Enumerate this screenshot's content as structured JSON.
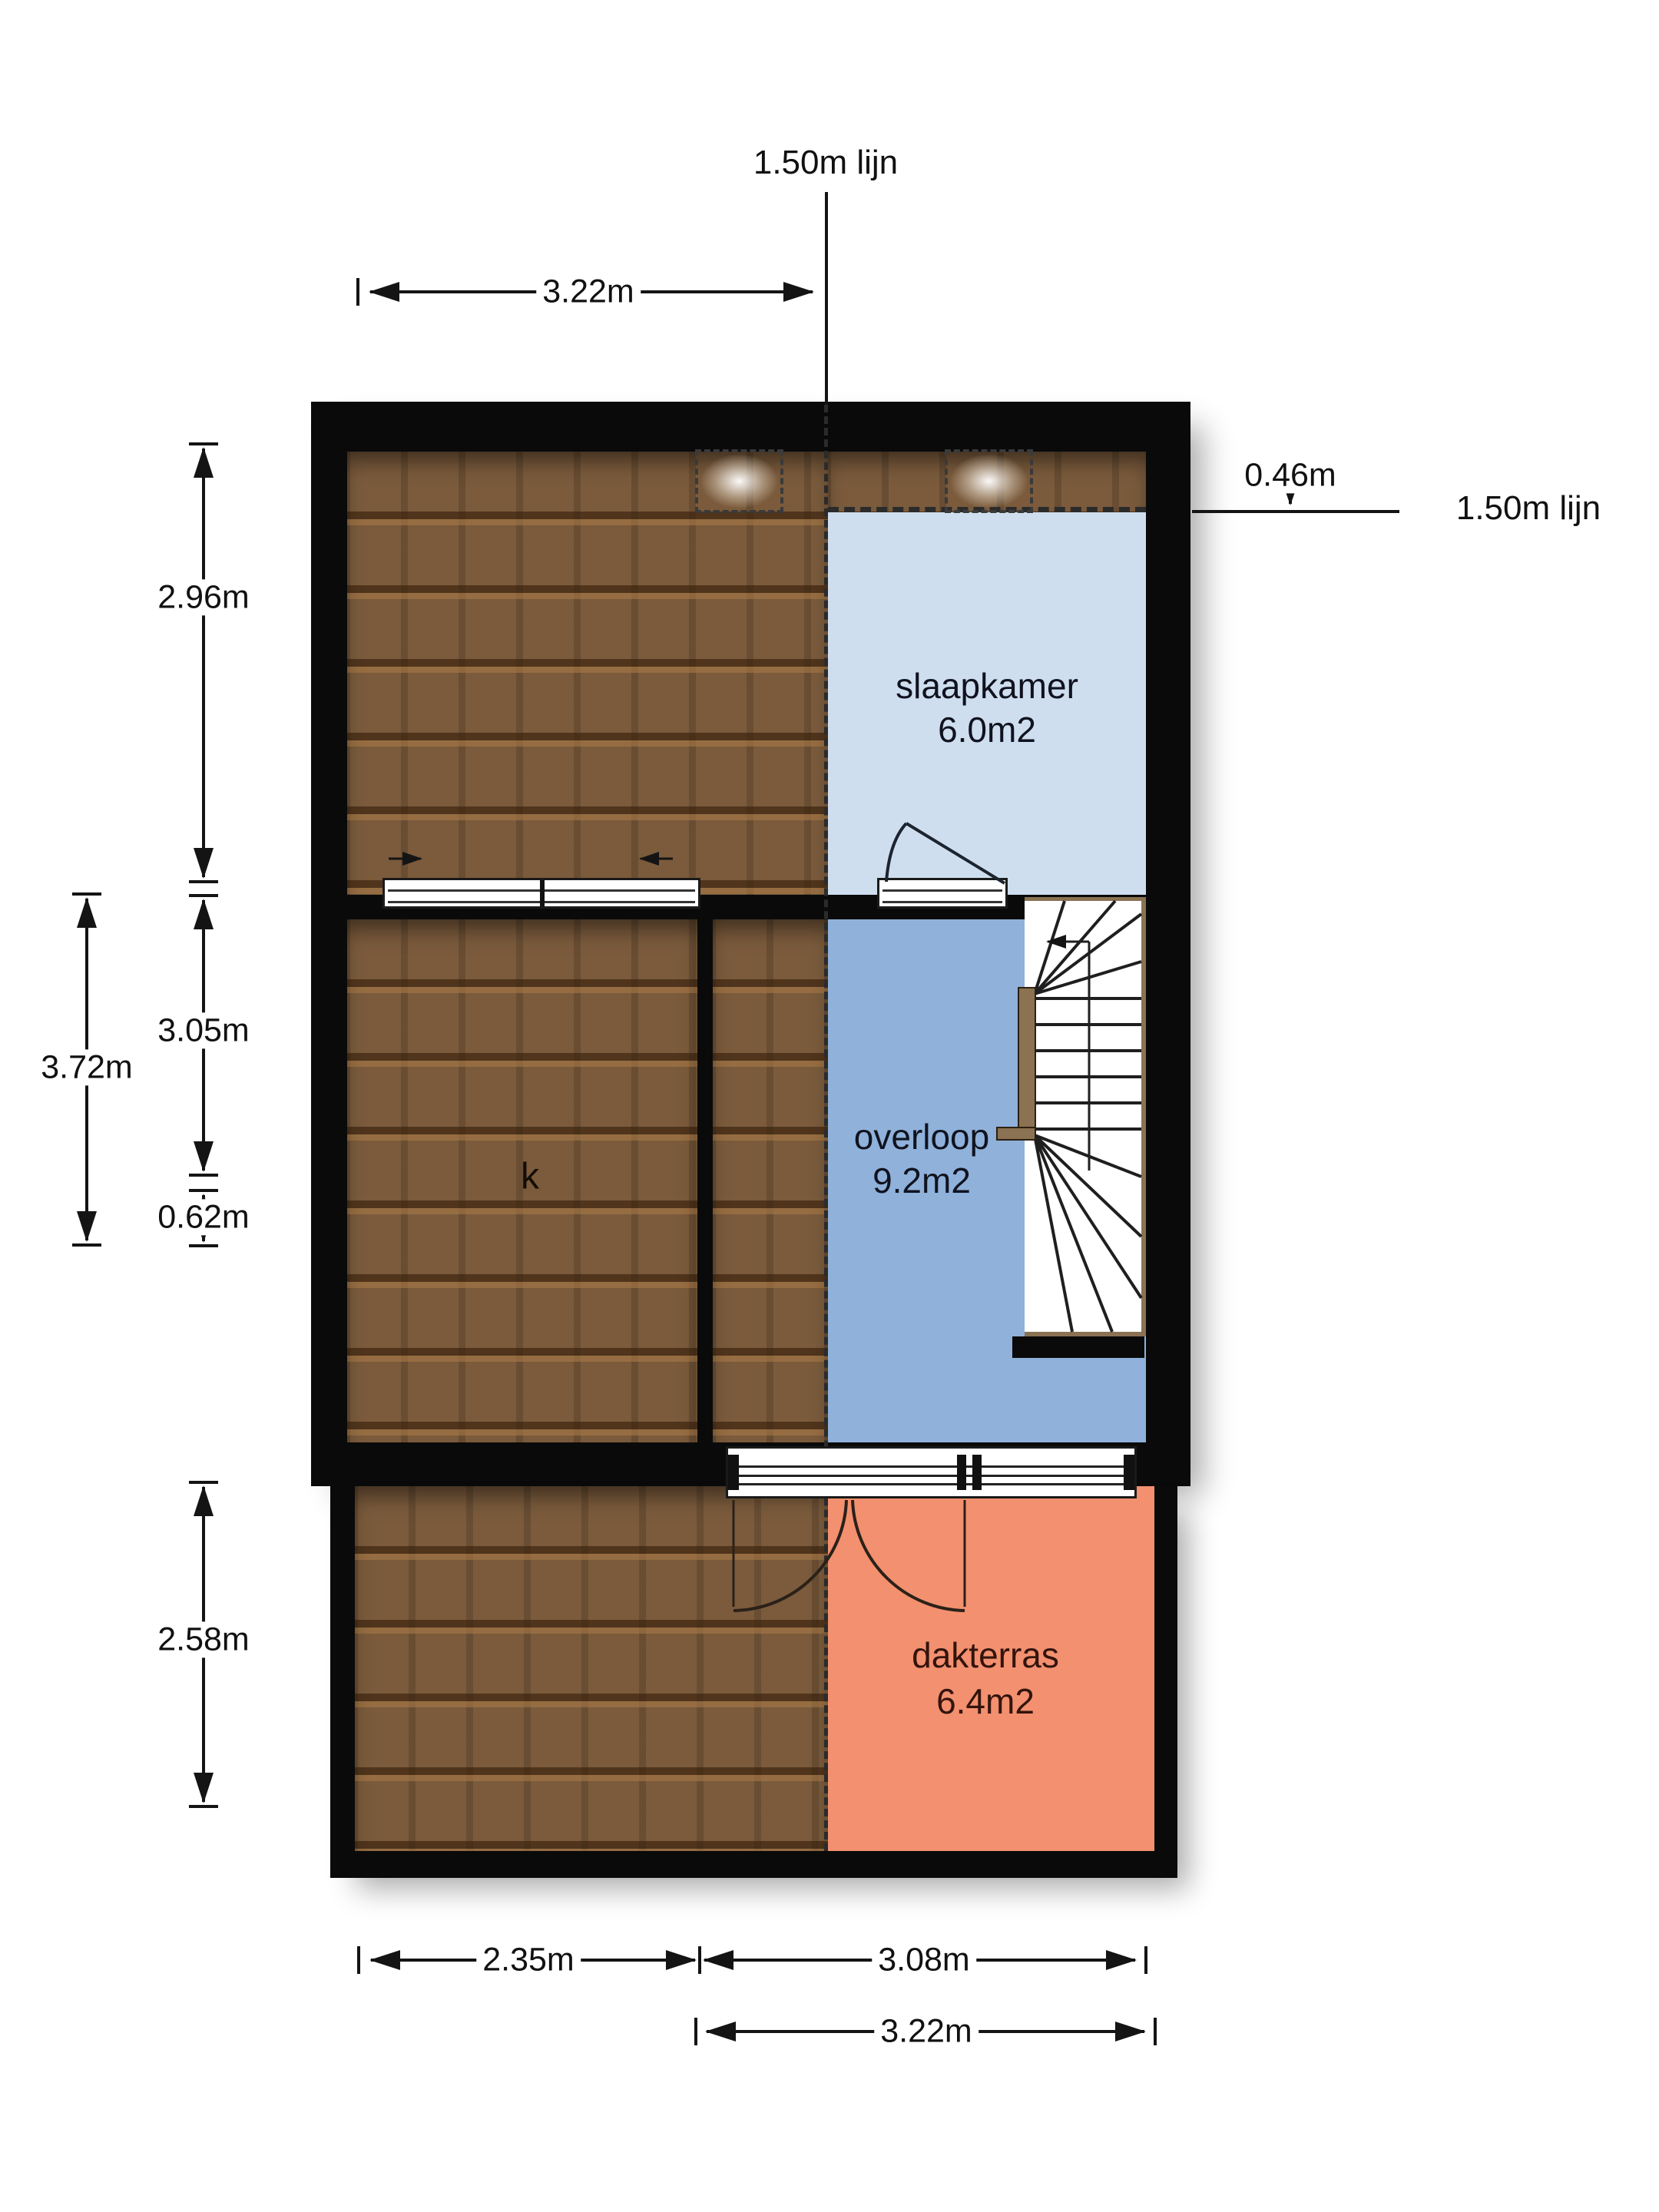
{
  "labels": {
    "line_top": "1.50m lijn",
    "line_right": "1.50m lijn"
  },
  "dimensions": {
    "top_width": "3.22m",
    "left_total": "3.72m",
    "left_upper": "2.96m",
    "left_middle": "3.05m",
    "left_small": "0.62m",
    "left_bottom": "2.58m",
    "right_offset": "0.46m",
    "bottom_left": "2.35m",
    "bottom_right": "3.08m",
    "bottom_total": "3.22m"
  },
  "rooms": {
    "slaapkamer": {
      "name": "slaapkamer",
      "area": "6.0m2"
    },
    "overloop": {
      "name": "overloop",
      "area": "9.2m2"
    },
    "dakterras": {
      "name": "dakterras",
      "area": "6.4m2"
    },
    "kast": {
      "name": "k"
    }
  },
  "colors": {
    "wall": "#0a0a0a",
    "roof": "#7b5b3c",
    "slaapkamer_fill": "#cfdeee",
    "overloop_fill": "#8fb1da",
    "dakterras_fill": "#f2906f"
  }
}
